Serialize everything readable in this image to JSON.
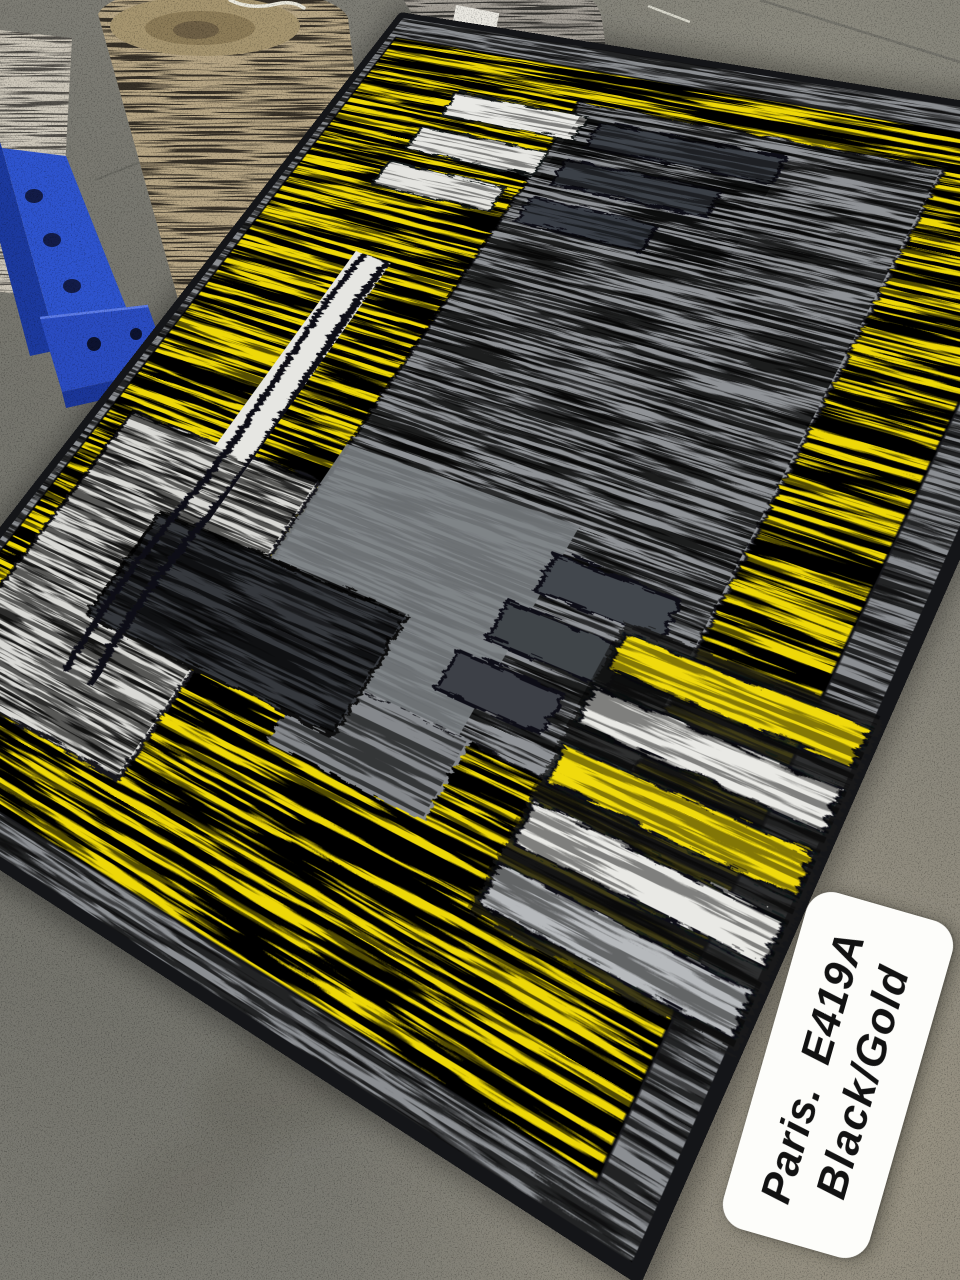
{
  "label": {
    "line1": "Paris.  E419A",
    "line2": "Black/Gold"
  },
  "colors": {
    "rug_yellow": "#EED808",
    "rug_black_edge": "#141518",
    "rug_gray_panel": "#8F9296",
    "rug_light_panel": "#D9D9D5",
    "rug_charcoal_block": "#34383D",
    "rug_outer_band": "#8B8E92",
    "label_bg": "#FDFDFA",
    "label_text": "#121212",
    "floor_concrete": "#7D7C74",
    "pallet_rack_blue": "#2E54CF",
    "rolled_rug_beige": "#B6A584",
    "rolled_rug_gray": "#A19C94"
  }
}
